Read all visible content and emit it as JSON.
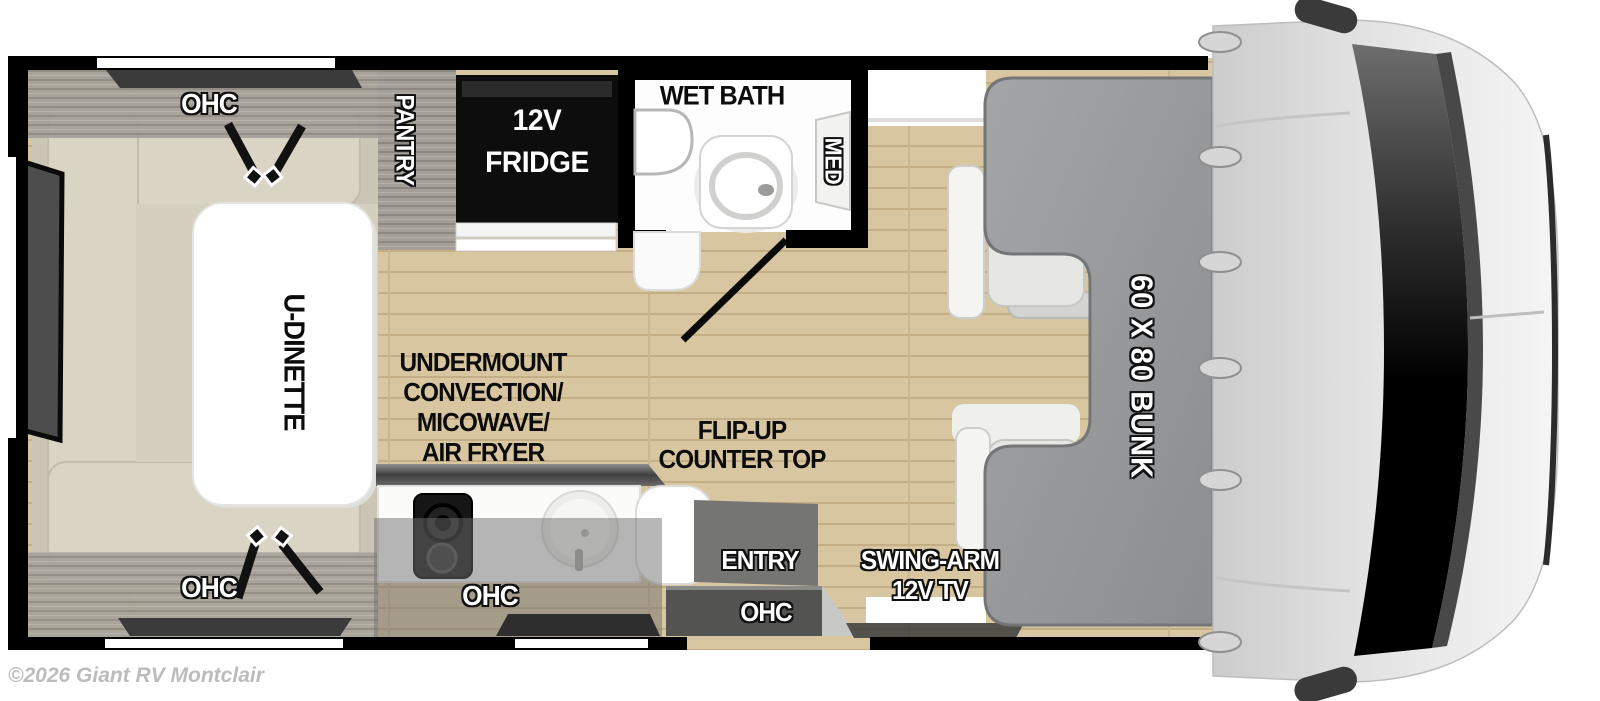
{
  "watermark": "©2026 Giant RV Montclair",
  "colors": {
    "floor_wood": "#d8c6a0",
    "wall": "#000000",
    "bunk_gray": "#97999b",
    "bench_beige": "#dad4c4",
    "cab_body_gray": "#d9d9d9",
    "overhead_overlay_gray": "#6f6f6f",
    "label_white": "#ffffff",
    "label_black": "#0c0c0c"
  },
  "labels": {
    "dinette": {
      "table": "U-DINETTE",
      "ohc_top": "OHC",
      "ohc_bottom": "OHC"
    },
    "pantry": "PANTRY",
    "fridge": {
      "line1": "12V",
      "line2": "FRIDGE"
    },
    "wet_bath": {
      "title": "WET BATH",
      "med": "MED"
    },
    "kitchen": {
      "appliance": {
        "line1": "UNDERMOUNT",
        "line2": "CONVECTION/",
        "line3": "MICOWAVE/",
        "line4": "AIR FRYER"
      },
      "flip_up": {
        "line1": "FLIP-UP",
        "line2": "COUNTER TOP"
      },
      "ohc": "OHC"
    },
    "entry": {
      "door": "ENTRY",
      "ohc": "OHC"
    },
    "tv": {
      "line1": "SWING-ARM",
      "line2": "12V TV"
    },
    "bunk": "60 X 80 BUNK"
  }
}
